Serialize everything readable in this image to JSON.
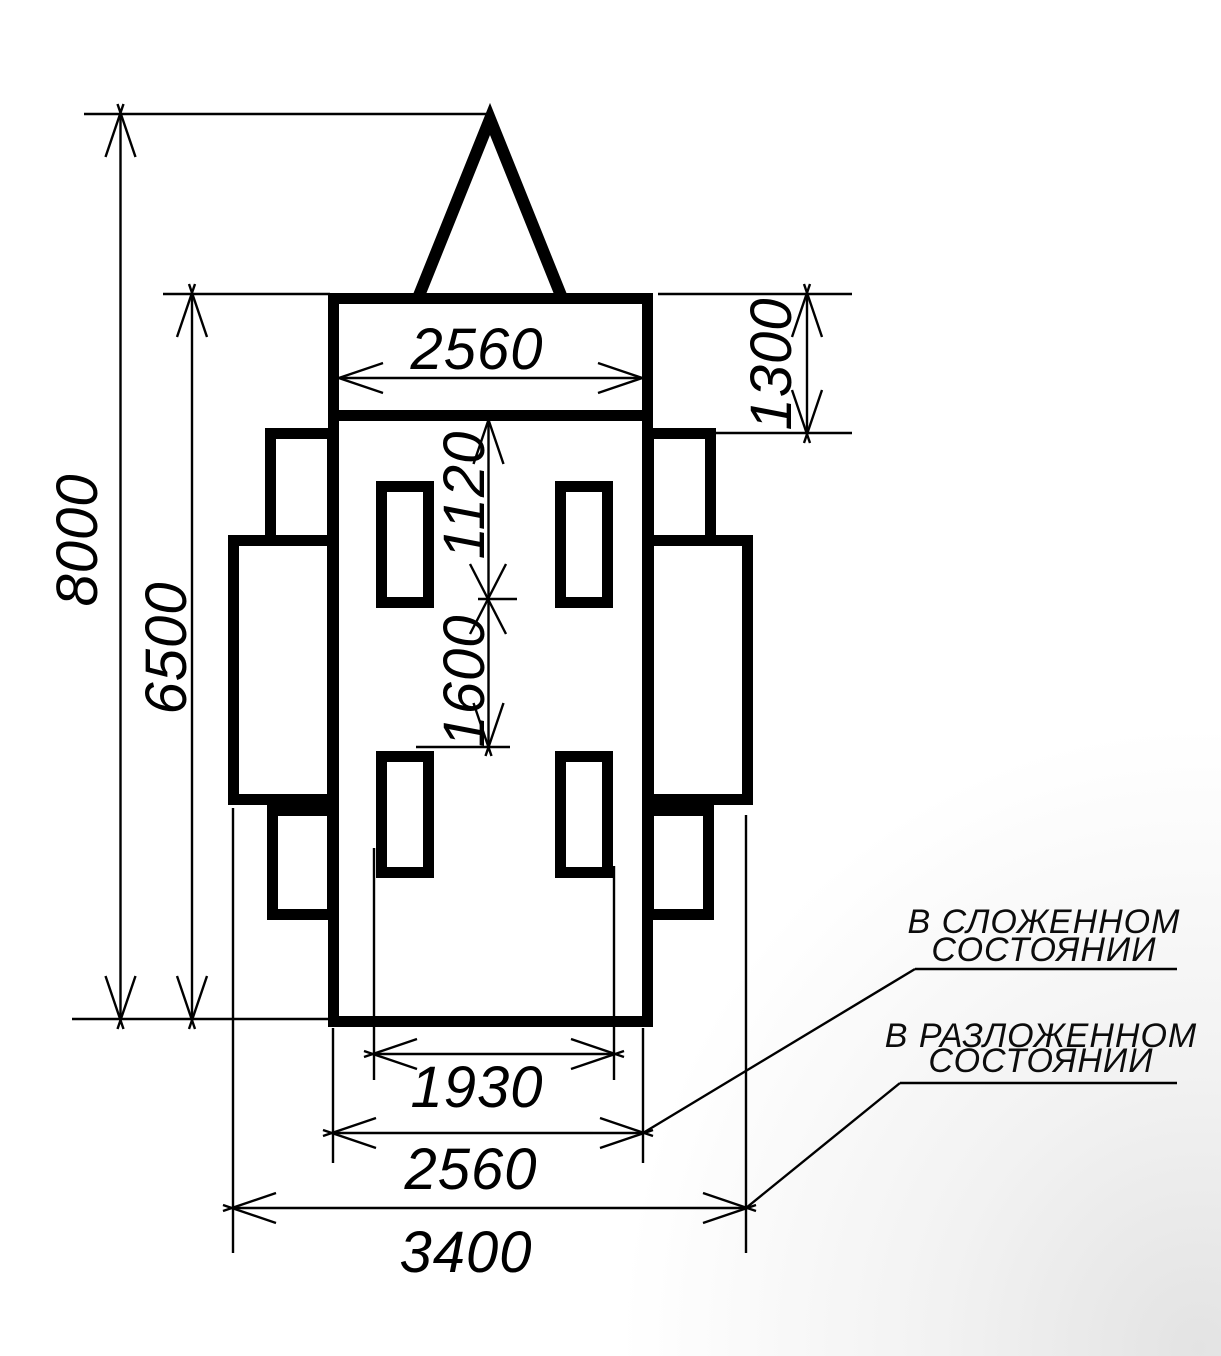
{
  "drawing": {
    "dimensions": {
      "overall_length": "8000",
      "body_length": "6500",
      "front_width": "2560",
      "hitch_box_length": "1300",
      "front_axle_offset": "1120",
      "axle_spacing": "1600",
      "wheel_track": "1930",
      "body_width": "2560",
      "unfolded_width": "3400"
    },
    "notes": {
      "folded": {
        "line1": "В СЛОЖЕННОМ",
        "line2": "СОСТОЯНИИ"
      },
      "unfolded": {
        "line1": "В РАЗЛОЖЕННОМ",
        "line2": "СОСТОЯНИИ"
      }
    },
    "colors": {
      "line": "#000000",
      "background": "#ffffff",
      "corner_shade": "#e3e3e3"
    }
  }
}
